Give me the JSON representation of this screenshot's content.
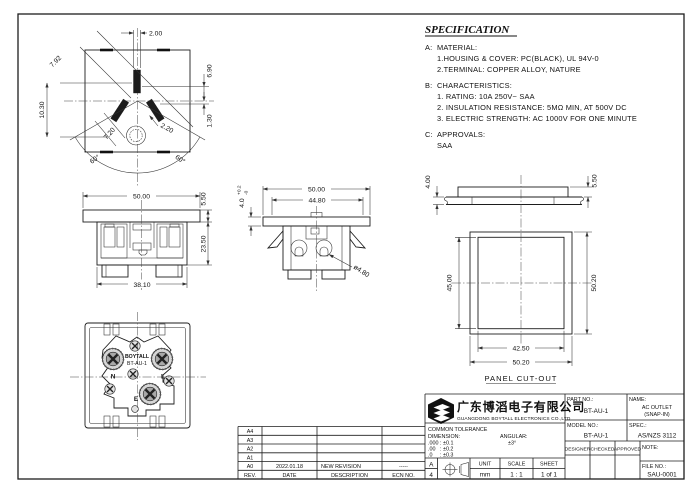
{
  "spec": {
    "title": "SPECIFICATION",
    "a_label": "A:",
    "a_heading": "MATERIAL:",
    "a1": "1.HOUSING & COVER: PC(BLACK), UL 94V-0",
    "a2": "2.TERMINAL: COPPER ALLOY, NATURE",
    "b_label": "B:",
    "b_heading": "CHARACTERISTICS:",
    "b1": "1. RATING: 10A 250V~ SAA",
    "b2": "2. INSULATION RESISTANCE: 5MΩ MIN, AT 500V DC",
    "b3": "3. ELECTRIC STRENGTH: AC 1000V FOR ONE MINUTE",
    "c_label": "C:",
    "c_heading": "APPROVALS:",
    "c1": "SAA"
  },
  "views": {
    "face": {
      "dim_top": "2.00",
      "dim_diag": "7.92",
      "dim_right_upper": "6.90",
      "dim_right_lower": "1.30",
      "dim_left": "10.30",
      "dim_slot": "7.20",
      "dim_hole": "2.20",
      "angle_left": "60°",
      "angle_right": "60°"
    },
    "front": {
      "dim_width": "50.00",
      "dim_flange": "5.50",
      "dim_height": "23.50",
      "dim_body": "38.10"
    },
    "side": {
      "dim_width": "50.00",
      "dim_inner": "44.80",
      "dim_flange": "4.0",
      "tol_plus": "+0.2",
      "tol_minus": "-0",
      "dim_hole": "ø4.80"
    },
    "back": {
      "brand": "BOYTALL",
      "model": "BT-AU-1",
      "neutral": "N",
      "live": "L",
      "earth": "E"
    },
    "panel": {
      "dim_panel": "4.00",
      "dim_flange": "5.50",
      "dim_inner_h": "45.00",
      "dim_outer_h": "50.20",
      "dim_inner_w": "42.50",
      "dim_outer_w": "50.20",
      "caption": "PANEL CUT-OUT"
    }
  },
  "title_block": {
    "company_cn": "广东博滔电子有限公司",
    "company_en": "GUANGDONG BOYTALL ELECTRONICS CO.,LTD",
    "part_no_label": "PART NO.:",
    "part_no": "BT-AU-1",
    "name_label": "NAME:",
    "name1": "AC OUTLET",
    "name2": "(SNAP-IN)",
    "model_no_label": "MODEL NO.:",
    "model_no": "BT-AU-1",
    "spec_label": "SPEC.:",
    "spec_value": "AS/NZS 3112",
    "designer_label": "DESIGNER",
    "checked_label": "CHECKED",
    "approved_label": "APPROVED",
    "note_label": "NOTE:",
    "file_no_label": "FILE NO.:",
    "file_no": "SAU-0001",
    "tol_title": "COMMON TOLERANCE",
    "tol_dim_label": "DIMENSION:",
    "tol_ang_label": "ANGULAR:",
    "tol_row1": ".000 : ±0.1",
    "tol_row2": ".00   : ±0.2",
    "tol_row3": ".0     : ±0.3",
    "tol_ang_value": "±3°",
    "paper_a": "A",
    "paper_4": "4",
    "unit_label": "UNIT",
    "unit_value": "mm",
    "scale_label": "SCALE",
    "scale_value": "1 : 1",
    "sheet_label": "SHEET",
    "sheet_value": "1 of 1"
  },
  "revision": {
    "header": {
      "rev": "REV.",
      "date": "DATE",
      "desc": "DESCRIPTION",
      "ecn": "ECN NO."
    },
    "rows": [
      {
        "rev": "A4",
        "date": "",
        "desc": "",
        "ecn": ""
      },
      {
        "rev": "A3",
        "date": "",
        "desc": "",
        "ecn": ""
      },
      {
        "rev": "A2",
        "date": "",
        "desc": "",
        "ecn": ""
      },
      {
        "rev": "A1",
        "date": "",
        "desc": "",
        "ecn": ""
      },
      {
        "rev": "A0",
        "date": "2022.01.18",
        "desc": "NEW REVISION",
        "ecn": "-----"
      }
    ]
  }
}
